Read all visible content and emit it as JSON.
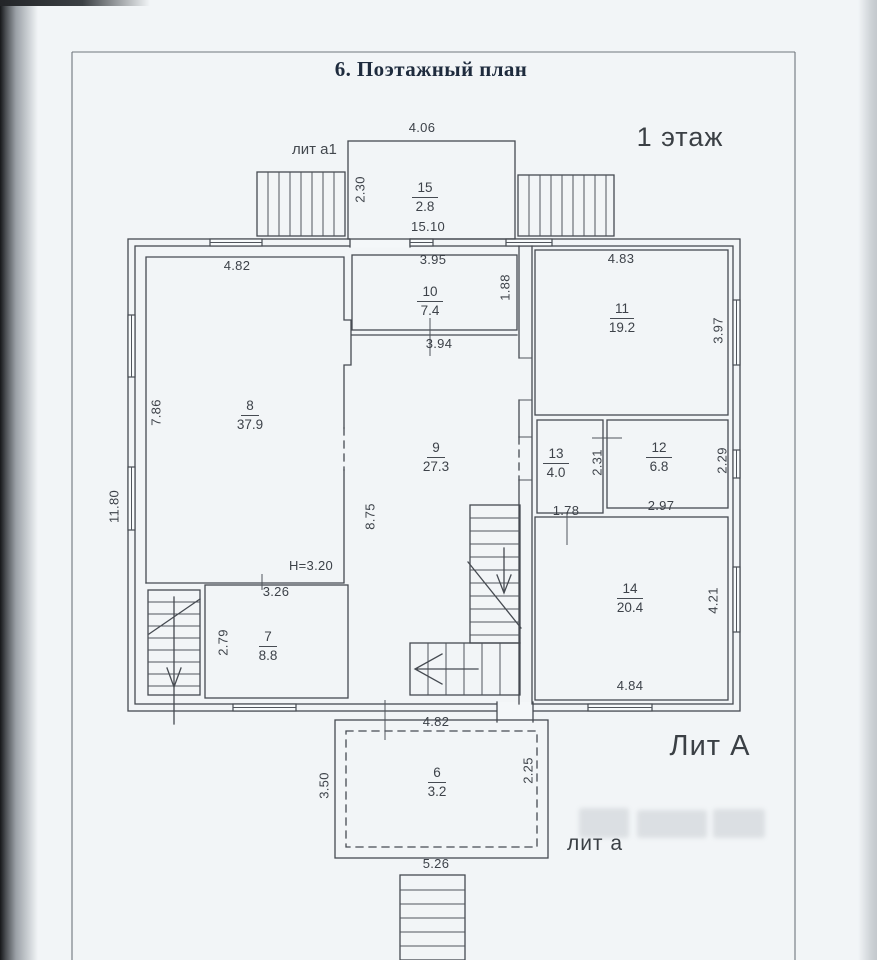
{
  "labels": {
    "title": "6. Поэтажный план",
    "floor": "1 этаж",
    "lit_A": "Лит А",
    "lit_a": "лит а",
    "lit_a1": "лит а1"
  },
  "rooms": {
    "r6": {
      "number": "6",
      "area": "3.2"
    },
    "r7": {
      "number": "7",
      "area": "8.8"
    },
    "r8": {
      "number": "8",
      "area": "37.9"
    },
    "r9": {
      "number": "9",
      "area": "27.3"
    },
    "r10": {
      "number": "10",
      "area": "7.4"
    },
    "r11": {
      "number": "11",
      "area": "19.2"
    },
    "r12": {
      "number": "12",
      "area": "6.8"
    },
    "r13": {
      "number": "13",
      "area": "4.0"
    },
    "r14": {
      "number": "14",
      "area": "20.4"
    },
    "r15": {
      "number": "15",
      "area": "2.8"
    }
  },
  "dims": {
    "annex15_top": "4.06",
    "annex15_left": "2.30",
    "top_total": "15.10",
    "r8_top": "4.82",
    "r8_left": "7.86",
    "left_total": "11.80",
    "r10_top": "3.95",
    "r10_right": "1.88",
    "r11_top": "4.83",
    "r11_right": "3.97",
    "r9_top": "3.94",
    "r9_left": "8.75",
    "r13_right": "2.31",
    "r13_bottom": "1.78",
    "r12_right": "2.29",
    "r12_bottom": "2.97",
    "height_note": "H=3.20",
    "r7_top": "3.26",
    "r7_left": "2.79",
    "r14_right": "4.21",
    "r14_bottom": "4.84",
    "r6_top": "4.82",
    "r6_left": "3.50",
    "r6_right": "2.25",
    "r6_bottom": "5.26"
  },
  "colors": {
    "paper": "#f2f5f7",
    "ink": "#464b52",
    "title_ink": "#1e2b3d"
  }
}
